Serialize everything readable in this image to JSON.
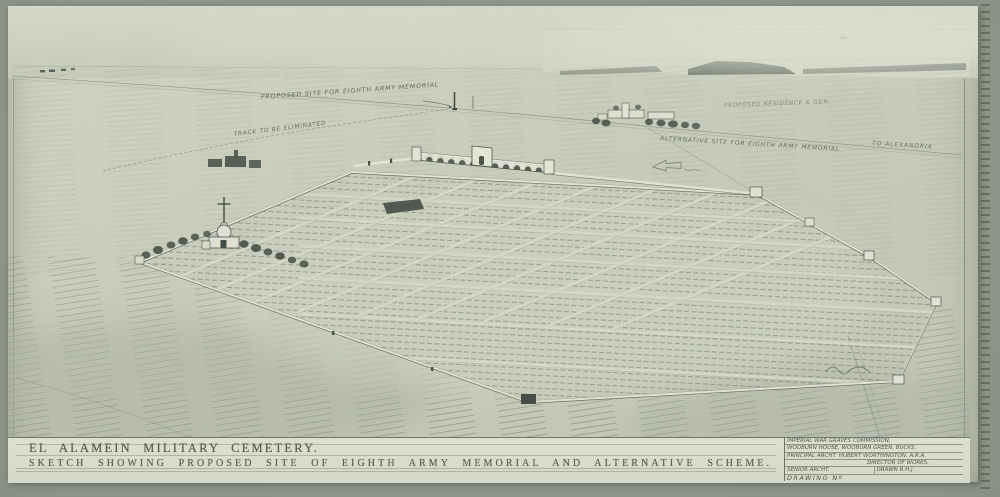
{
  "artwork": {
    "kind": "pencil perspective sketch, aerial view of walled desert cemetery",
    "title_line1": "EL ALAMEIN MILITARY CEMETERY.",
    "title_line2": "SKETCH SHOWING PROPOSED SITE OF EIGHTH ARMY MEMORIAL AND ALTERNATIVE SCHEME."
  },
  "info_block": {
    "line1": "IMPERIAL WAR GRAVES COMMISSION,",
    "line2": "WOOBURN HOUSE, WOOBURN GREEN, BUCKS.",
    "line3": "PRINCIPAL ARCHT. HUBERT WORTHINGTON, A.R.A.",
    "line4": "DIRECTOR OF WORKS.",
    "senior_archt_label": "SENIOR ARCHT.",
    "drawn_label": "DRAWN R.H.J.",
    "drawing_no_label": "DRAWING Nº"
  },
  "annotations": {
    "proposed_site": "PROPOSED SITE FOR EIGHTH ARMY MEMORIAL",
    "track": "TRACK TO BE ELIMINATED",
    "residence": "PROPOSED RESIDENCE & GDN.",
    "alternative_site": "ALTERNATIVE SITE FOR EIGHTH ARMY MEMORIAL",
    "to_alexandria": "TO ALEXANDRIA"
  },
  "colors": {
    "mount_board": "#8a9185",
    "paper": "#cccfbe",
    "pencil_dark": "#46504a",
    "pencil_mid": "#6d766a",
    "wall_highlight": "#e6e7d8"
  }
}
